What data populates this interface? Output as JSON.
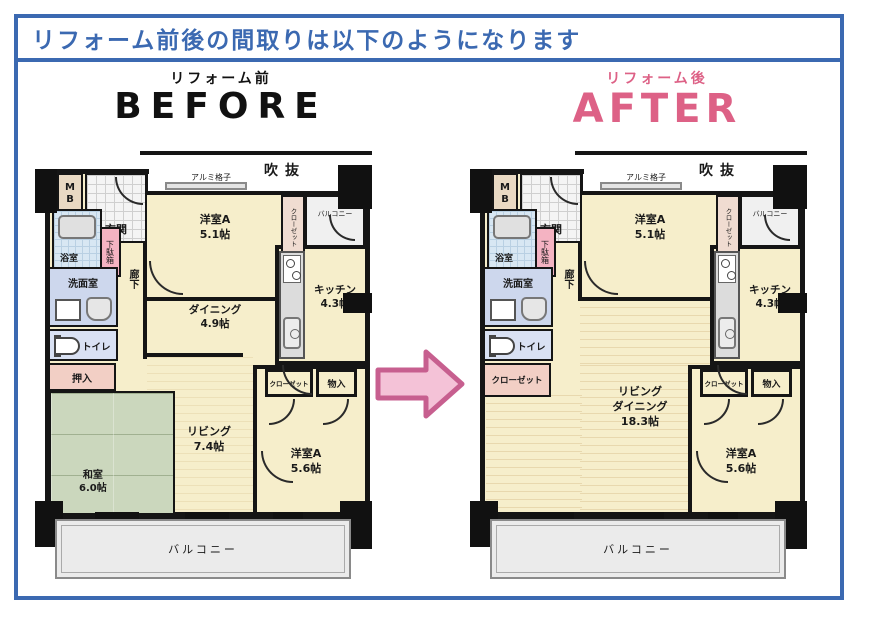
{
  "header": {
    "title": "リフォーム前後の間取りは以下のようになります"
  },
  "before": {
    "caption": "リフォーム前",
    "title": "BEFORE",
    "plan": {
      "void": "吹抜",
      "alumi_lattice": "アルミ格子",
      "meter_box": "MB",
      "entrance": "玄関",
      "shoe_cabinet": "下駄箱",
      "bathroom": "浴室",
      "washroom": "洗面室",
      "toilet": "トイレ",
      "oshiire": "押入",
      "washitsu_name": "和室",
      "washitsu_size": "6.0帖",
      "corridor": "廊下",
      "room_a1_name": "洋室A",
      "room_a1_size": "5.1帖",
      "closet_vertical": "クローゼット",
      "balcony_small": "バルコニー",
      "kitchen_name": "キッチン",
      "kitchen_size": "4.3帖",
      "dining_name": "ダイニング",
      "dining_size": "4.9帖",
      "living_name": "リビング",
      "living_size": "7.4帖",
      "closet_small": "クローゼット",
      "storage": "物入",
      "room_a2_name": "洋室A",
      "room_a2_size": "5.6帖",
      "balcony": "バルコニー"
    }
  },
  "after": {
    "caption": "リフォーム後",
    "title": "AFTER",
    "plan": {
      "void": "吹抜",
      "alumi_lattice": "アルミ格子",
      "meter_box": "MB",
      "entrance": "玄関",
      "shoe_cabinet": "下駄箱",
      "bathroom": "浴室",
      "washroom": "洗面室",
      "toilet": "トイレ",
      "closet_entry": "クローゼット",
      "corridor": "廊下",
      "room_a1_name": "洋室A",
      "room_a1_size": "5.1帖",
      "closet_vertical": "クローゼット",
      "balcony_small": "バルコニー",
      "kitchen_name": "キッチン",
      "kitchen_size": "4.3帖",
      "ld_line1": "リビング",
      "ld_line2": "ダイニング",
      "ld_size": "18.3帖",
      "closet_small": "クローゼット",
      "storage": "物入",
      "room_a2_name": "洋室A",
      "room_a2_size": "5.6帖",
      "balcony": "バルコニー"
    }
  },
  "colors": {
    "accent_blue": "#3b69b1",
    "after_pink": "#dd6186",
    "arrow_fill": "#f4c2d7",
    "arrow_stroke": "#c75f8f",
    "room_beige": "#f6eecb",
    "tatami_green": "#cbd7bd",
    "bath_blue": "#d8e7f3",
    "washroom_lavender": "#cdd7ed",
    "pink_cabinet": "#f4b3c2"
  }
}
